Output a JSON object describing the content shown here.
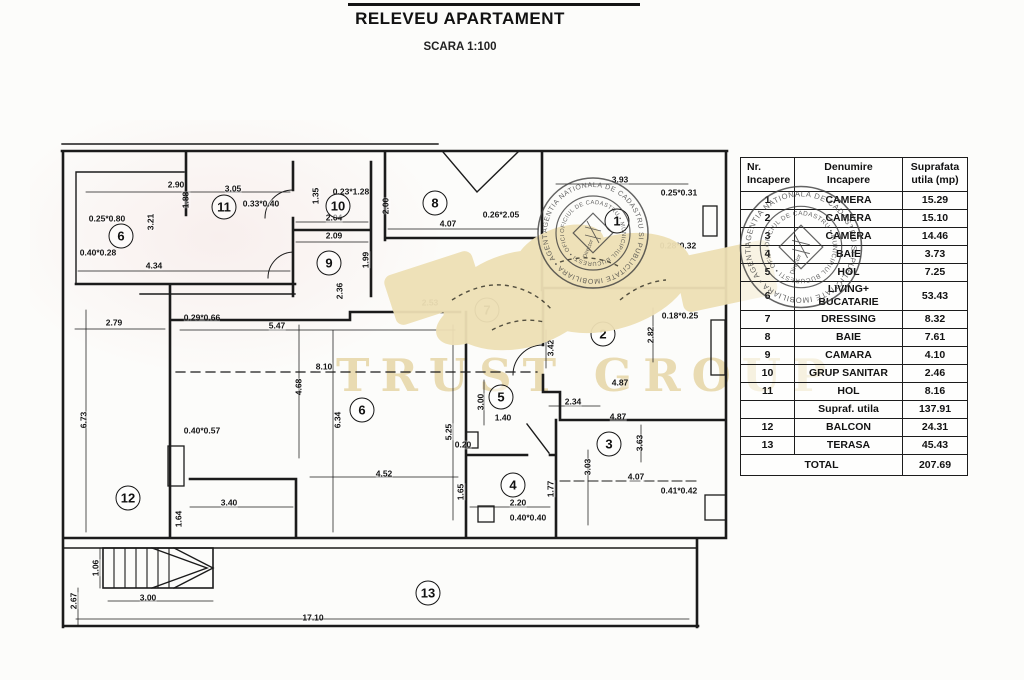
{
  "title": {
    "main": "RELEVEU APARTAMENT",
    "scale": "SCARA 1:100"
  },
  "table": {
    "headers": {
      "col1": [
        "Nr.",
        "Incapere"
      ],
      "col2": [
        "Denumire",
        "Incapere"
      ],
      "col3": [
        "Suprafata",
        "utila (mp)"
      ]
    },
    "rows": [
      {
        "nr": "1",
        "name": [
          "CAMERA"
        ],
        "area": "15.29"
      },
      {
        "nr": "2",
        "name": [
          "CAMERA"
        ],
        "area": "15.10"
      },
      {
        "nr": "3",
        "name": [
          "CAMERA"
        ],
        "area": "14.46"
      },
      {
        "nr": "4",
        "name": [
          "BAIE"
        ],
        "area": "3.73"
      },
      {
        "nr": "5",
        "name": [
          "HOL"
        ],
        "area": "7.25"
      },
      {
        "nr": "6",
        "name": [
          "LIVING+",
          "BUCATARIE"
        ],
        "area": "53.43"
      },
      {
        "nr": "7",
        "name": [
          "DRESSING"
        ],
        "area": "8.32"
      },
      {
        "nr": "8",
        "name": [
          "BAIE"
        ],
        "area": "7.61"
      },
      {
        "nr": "9",
        "name": [
          "CAMARA"
        ],
        "area": "4.10"
      },
      {
        "nr": "10",
        "name": [
          "GRUP SANITAR"
        ],
        "area": "2.46"
      },
      {
        "nr": "11",
        "name": [
          "HOL"
        ],
        "area": "8.16"
      },
      {
        "nr": "",
        "name": [
          "Supraf. utila"
        ],
        "area": "137.91"
      },
      {
        "nr": "12",
        "name": [
          "BALCON"
        ],
        "area": "24.31"
      },
      {
        "nr": "13",
        "name": [
          "TERASA"
        ],
        "area": "45.43"
      },
      {
        "nr": "",
        "name": [
          "TOTAL"
        ],
        "area": "207.69",
        "total": true
      }
    ]
  },
  "plan": {
    "rooms": [
      {
        "n": "1",
        "x": 617,
        "y": 221
      },
      {
        "n": "2",
        "x": 603,
        "y": 334
      },
      {
        "n": "3",
        "x": 609,
        "y": 444
      },
      {
        "n": "4",
        "x": 513,
        "y": 485
      },
      {
        "n": "5",
        "x": 501,
        "y": 397
      },
      {
        "n": "6",
        "x": 121,
        "y": 236
      },
      {
        "n": "6",
        "x": 362,
        "y": 410
      },
      {
        "n": "7",
        "x": 487,
        "y": 310
      },
      {
        "n": "8",
        "x": 435,
        "y": 203
      },
      {
        "n": "9",
        "x": 329,
        "y": 263
      },
      {
        "n": "10",
        "x": 338,
        "y": 206
      },
      {
        "n": "11",
        "x": 224,
        "y": 207
      },
      {
        "n": "12",
        "x": 128,
        "y": 498
      },
      {
        "n": "13",
        "x": 428,
        "y": 593
      }
    ],
    "dimensions": [
      {
        "t": "2.90",
        "x": 176,
        "y": 185
      },
      {
        "t": "3.05",
        "x": 233,
        "y": 189
      },
      {
        "t": "0.33*0.40",
        "x": 261,
        "y": 204
      },
      {
        "t": "1.88",
        "x": 186,
        "y": 200,
        "r": 1
      },
      {
        "t": "0.25*0.80",
        "x": 107,
        "y": 219
      },
      {
        "t": "3.21",
        "x": 151,
        "y": 222,
        "r": 1
      },
      {
        "t": "0.40*0.28",
        "x": 98,
        "y": 253
      },
      {
        "t": "4.34",
        "x": 154,
        "y": 266
      },
      {
        "t": "1.35",
        "x": 316,
        "y": 196,
        "r": 1
      },
      {
        "t": "0.23*1.28",
        "x": 351,
        "y": 192
      },
      {
        "t": "2.04",
        "x": 334,
        "y": 218
      },
      {
        "t": "2.09",
        "x": 334,
        "y": 236
      },
      {
        "t": "1.99",
        "x": 366,
        "y": 260,
        "r": 1
      },
      {
        "t": "2.00",
        "x": 386,
        "y": 206,
        "r": 1
      },
      {
        "t": "4.07",
        "x": 448,
        "y": 224
      },
      {
        "t": "0.26*2.05",
        "x": 501,
        "y": 215
      },
      {
        "t": "3.93",
        "x": 620,
        "y": 180
      },
      {
        "t": "0.25*0.31",
        "x": 679,
        "y": 193
      },
      {
        "t": "0.28*0.32",
        "x": 678,
        "y": 246
      },
      {
        "t": "2.36",
        "x": 340,
        "y": 291,
        "r": 1
      },
      {
        "t": "2.53",
        "x": 430,
        "y": 303
      },
      {
        "t": "2.79",
        "x": 114,
        "y": 323
      },
      {
        "t": "0.29*0.66",
        "x": 202,
        "y": 318
      },
      {
        "t": "5.47",
        "x": 277,
        "y": 326
      },
      {
        "t": "0.18*0.25",
        "x": 680,
        "y": 316
      },
      {
        "t": "3.42",
        "x": 551,
        "y": 348,
        "r": 1
      },
      {
        "t": "2.82",
        "x": 651,
        "y": 335,
        "r": 1
      },
      {
        "t": "8.10",
        "x": 324,
        "y": 367
      },
      {
        "t": "4.87",
        "x": 620,
        "y": 383
      },
      {
        "t": "6.73",
        "x": 84,
        "y": 420,
        "r": 1
      },
      {
        "t": "4.68",
        "x": 299,
        "y": 387,
        "r": 1
      },
      {
        "t": "6.34",
        "x": 338,
        "y": 420,
        "r": 1
      },
      {
        "t": "3.00",
        "x": 481,
        "y": 402,
        "r": 1
      },
      {
        "t": "2.34",
        "x": 573,
        "y": 402
      },
      {
        "t": "1.40",
        "x": 503,
        "y": 418
      },
      {
        "t": "4.87",
        "x": 618,
        "y": 417
      },
      {
        "t": "5.25",
        "x": 449,
        "y": 432,
        "r": 1
      },
      {
        "t": "0.40*0.57",
        "x": 202,
        "y": 431
      },
      {
        "t": "0.20",
        "x": 463,
        "y": 445
      },
      {
        "t": "3.63",
        "x": 640,
        "y": 443,
        "r": 1
      },
      {
        "t": "3.03",
        "x": 588,
        "y": 467,
        "r": 1
      },
      {
        "t": "4.52",
        "x": 384,
        "y": 474
      },
      {
        "t": "4.07",
        "x": 636,
        "y": 477
      },
      {
        "t": "1.65",
        "x": 461,
        "y": 492,
        "r": 1
      },
      {
        "t": "1.77",
        "x": 551,
        "y": 489,
        "r": 1
      },
      {
        "t": "0.41*0.42",
        "x": 679,
        "y": 491
      },
      {
        "t": "2.20",
        "x": 518,
        "y": 503
      },
      {
        "t": "3.40",
        "x": 229,
        "y": 503
      },
      {
        "t": "0.40*0.40",
        "x": 528,
        "y": 518
      },
      {
        "t": "1.64",
        "x": 179,
        "y": 519,
        "r": 1
      },
      {
        "t": "1.06",
        "x": 96,
        "y": 568,
        "r": 1
      },
      {
        "t": "3.00",
        "x": 148,
        "y": 598
      },
      {
        "t": "2.67",
        "x": 74,
        "y": 601,
        "r": 1
      },
      {
        "t": "17.10",
        "x": 313,
        "y": 618
      }
    ]
  },
  "watermark": {
    "text": "TRUST GROUP",
    "text_color": "#e7d8ab",
    "handshake_color": "#eee0b5"
  },
  "stamps": {
    "ring_text": "AGENTIA NATIONALA DE CADASTRU SI PUBLICITATE IMOBILIARA • AGENTIA NATIONALA •",
    "inner_text": "OFICIUL DE CADASTRU • MUNICIPIUL BUCURESTI • OFICIUL DE",
    "center_label": "Director"
  }
}
